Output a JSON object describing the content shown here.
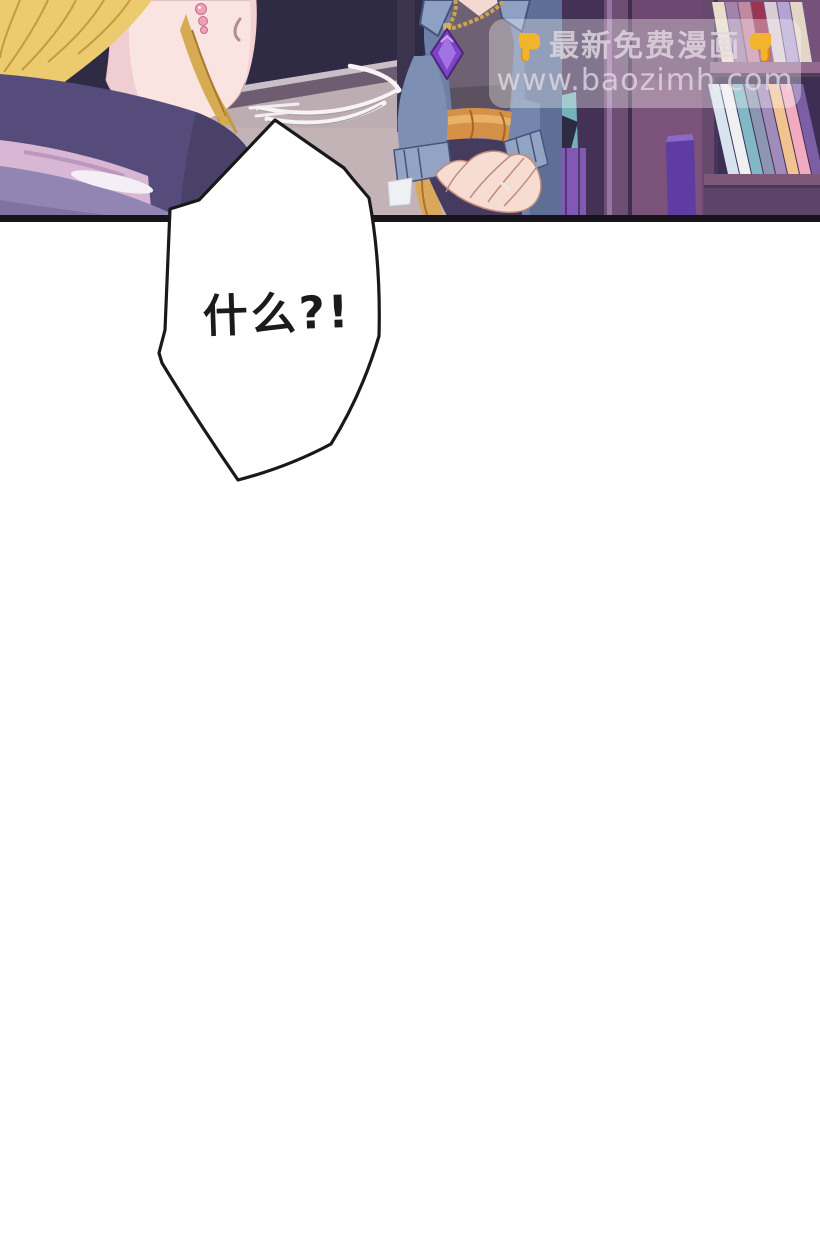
{
  "page": {
    "width": 820,
    "height": 1243,
    "background": "#ffffff"
  },
  "panel": {
    "border_color": "#16131b",
    "colors": {
      "wall": "#bcadb2",
      "window_navy": "#2f2b45",
      "hair_gold": "#ecca6e",
      "skin": "#f9e4e2",
      "garment_indigo": "#564c7c",
      "garment_pink": "#d7b7d3",
      "garment_violet": "#9285b3",
      "jacket_blue": "#6f81a8",
      "vest": "#6e6173",
      "sash_orange": "#d59147",
      "gem_purple": "#7e43c8",
      "bookshelf": "#5c4266"
    }
  },
  "watermark": {
    "line1": "最新免费漫画",
    "line2": "www.baozimh.com",
    "left_icon": "point-down-hand",
    "right_icon": "point-down-hand",
    "icon_color": "#f3b42d",
    "text_color": "rgba(225,216,225,0.82)",
    "background": "rgba(252,250,252,0.34)"
  },
  "speech_bubble": {
    "text": "什么?!",
    "fill": "#ffffff",
    "outline": "#191919"
  }
}
